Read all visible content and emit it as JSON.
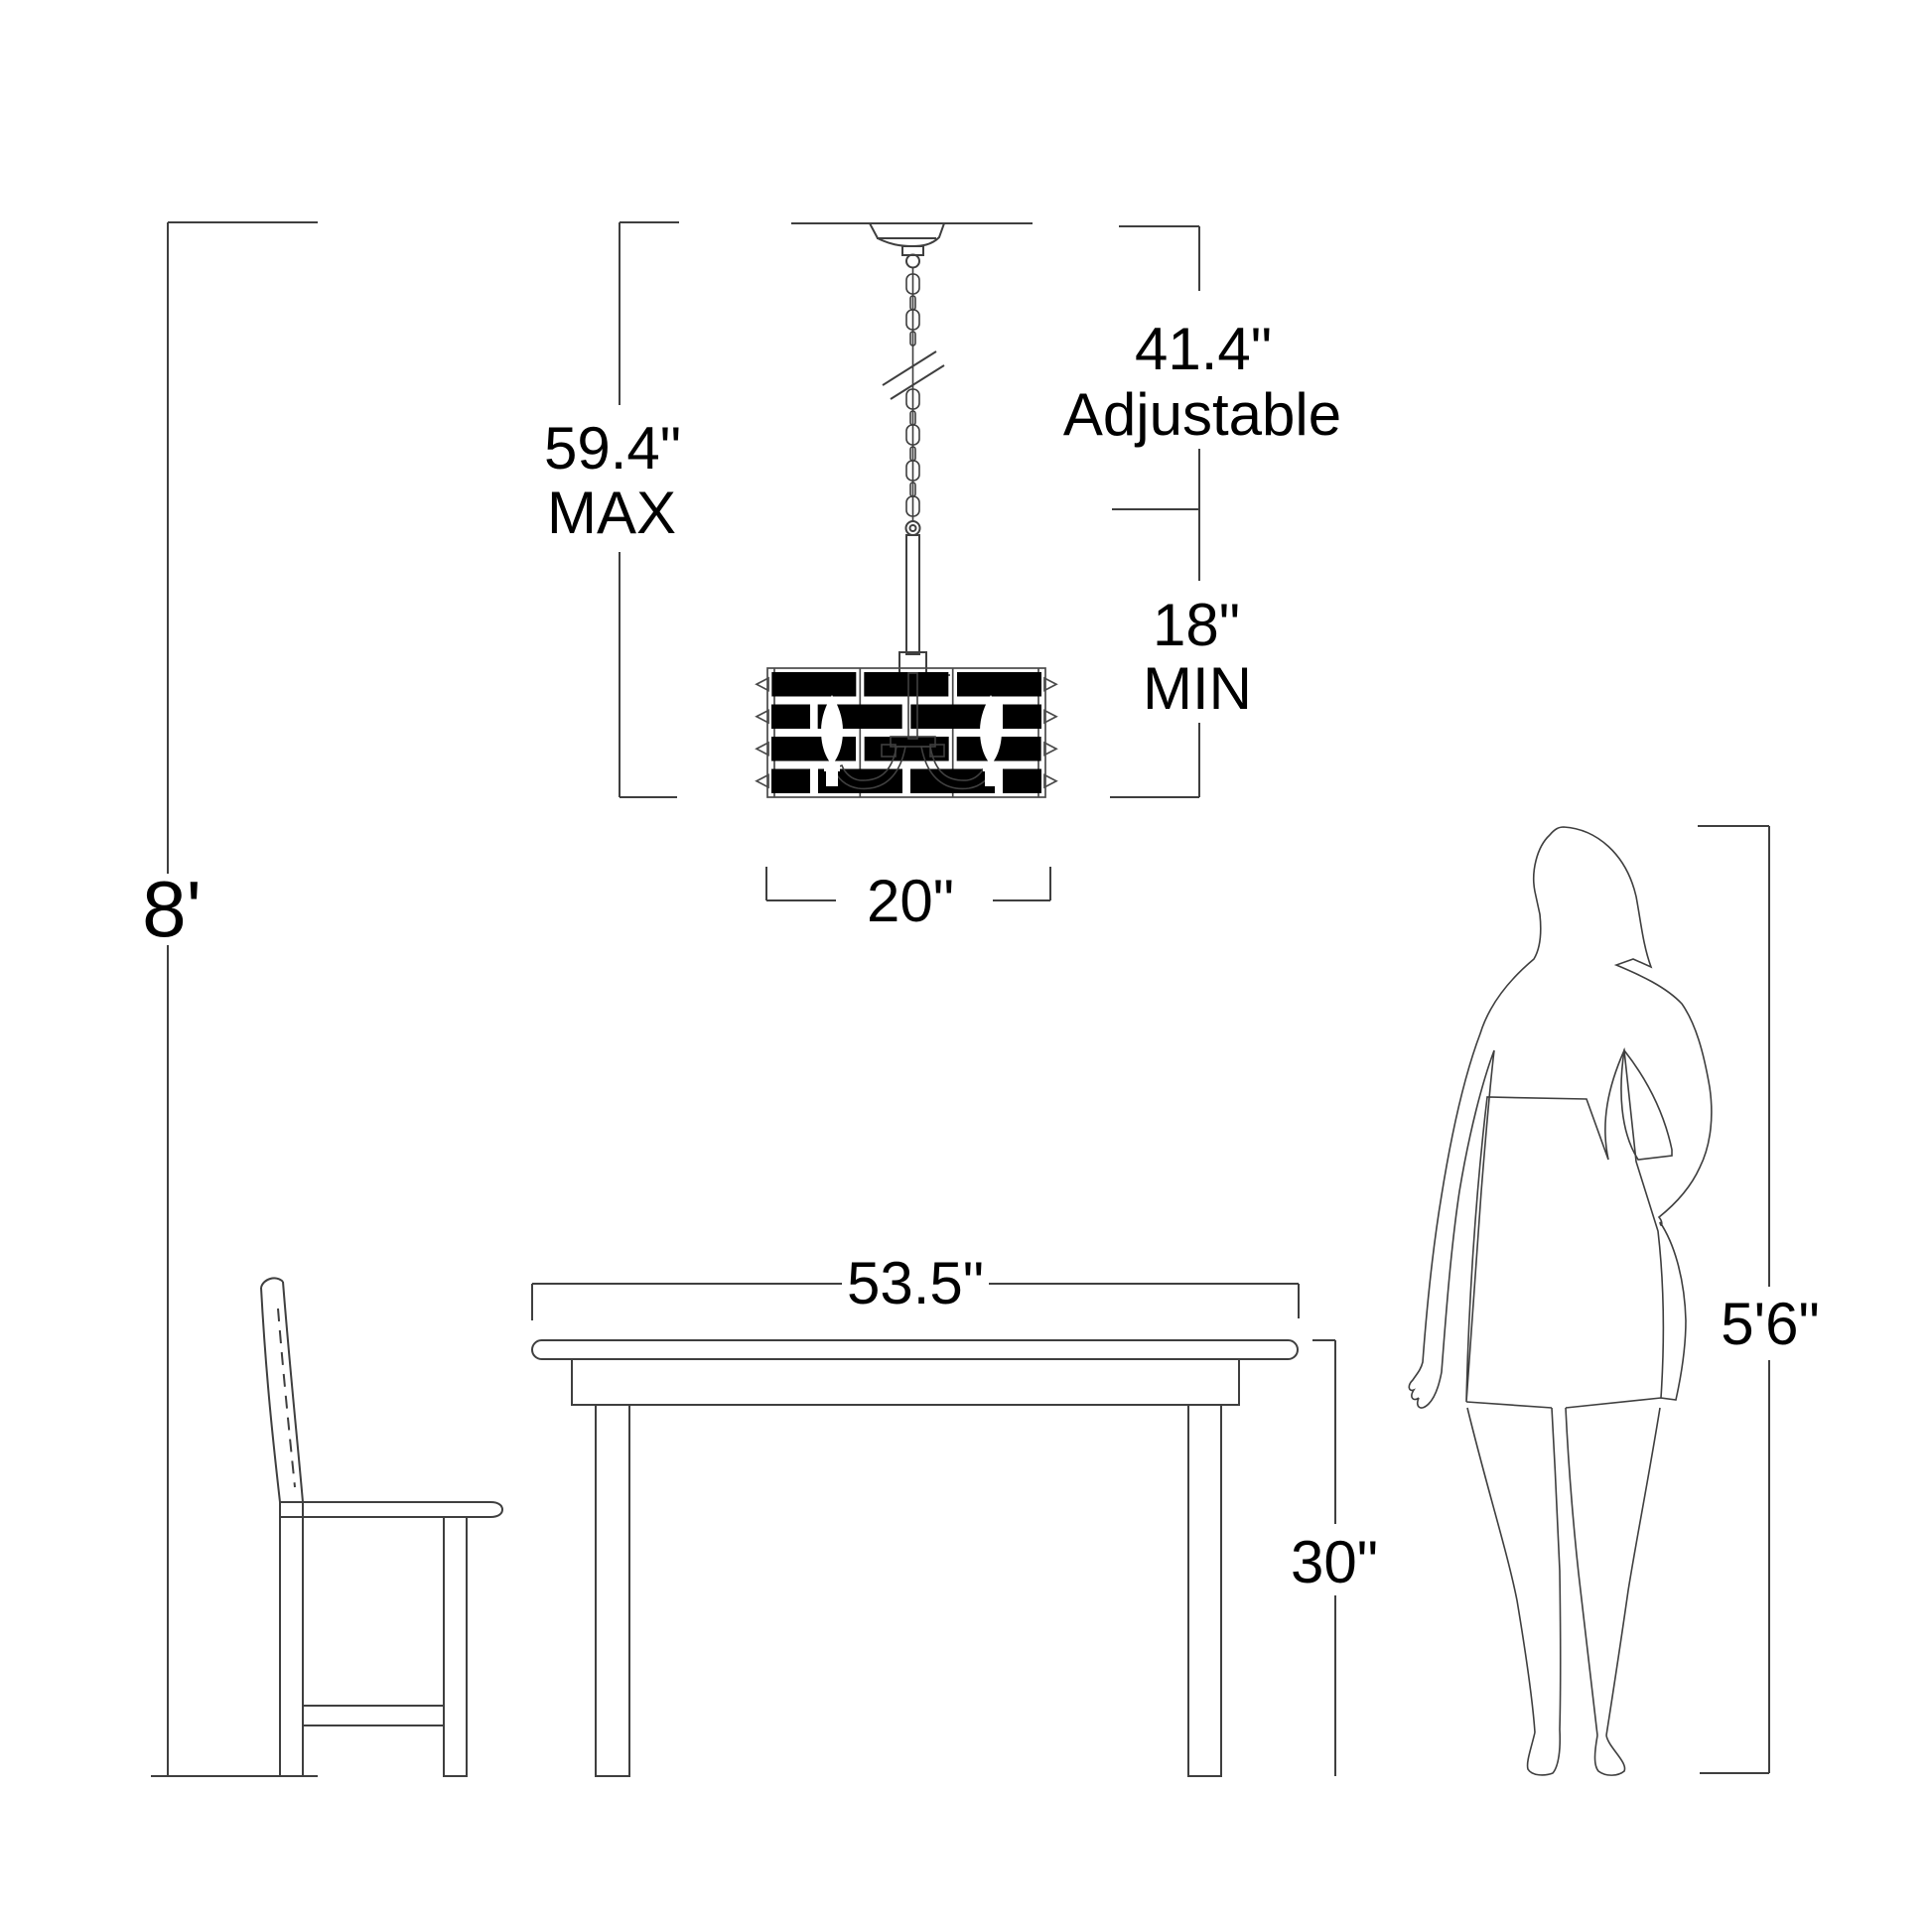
{
  "diagram": {
    "ceiling_height": "8'",
    "fixture_max_value": "59.4\"",
    "fixture_max_qualifier": "MAX",
    "adjustable_value": "41.4\"",
    "adjustable_qualifier": "Adjustable",
    "min_value": "18\"",
    "min_qualifier": "MIN",
    "shade_width": "20\"",
    "table_width": "53.5\"",
    "table_height": "30\"",
    "person_height": "5'6\""
  },
  "style": {
    "line_color": "#3f3f3f",
    "text_color": "#000000",
    "background": "#ffffff"
  }
}
